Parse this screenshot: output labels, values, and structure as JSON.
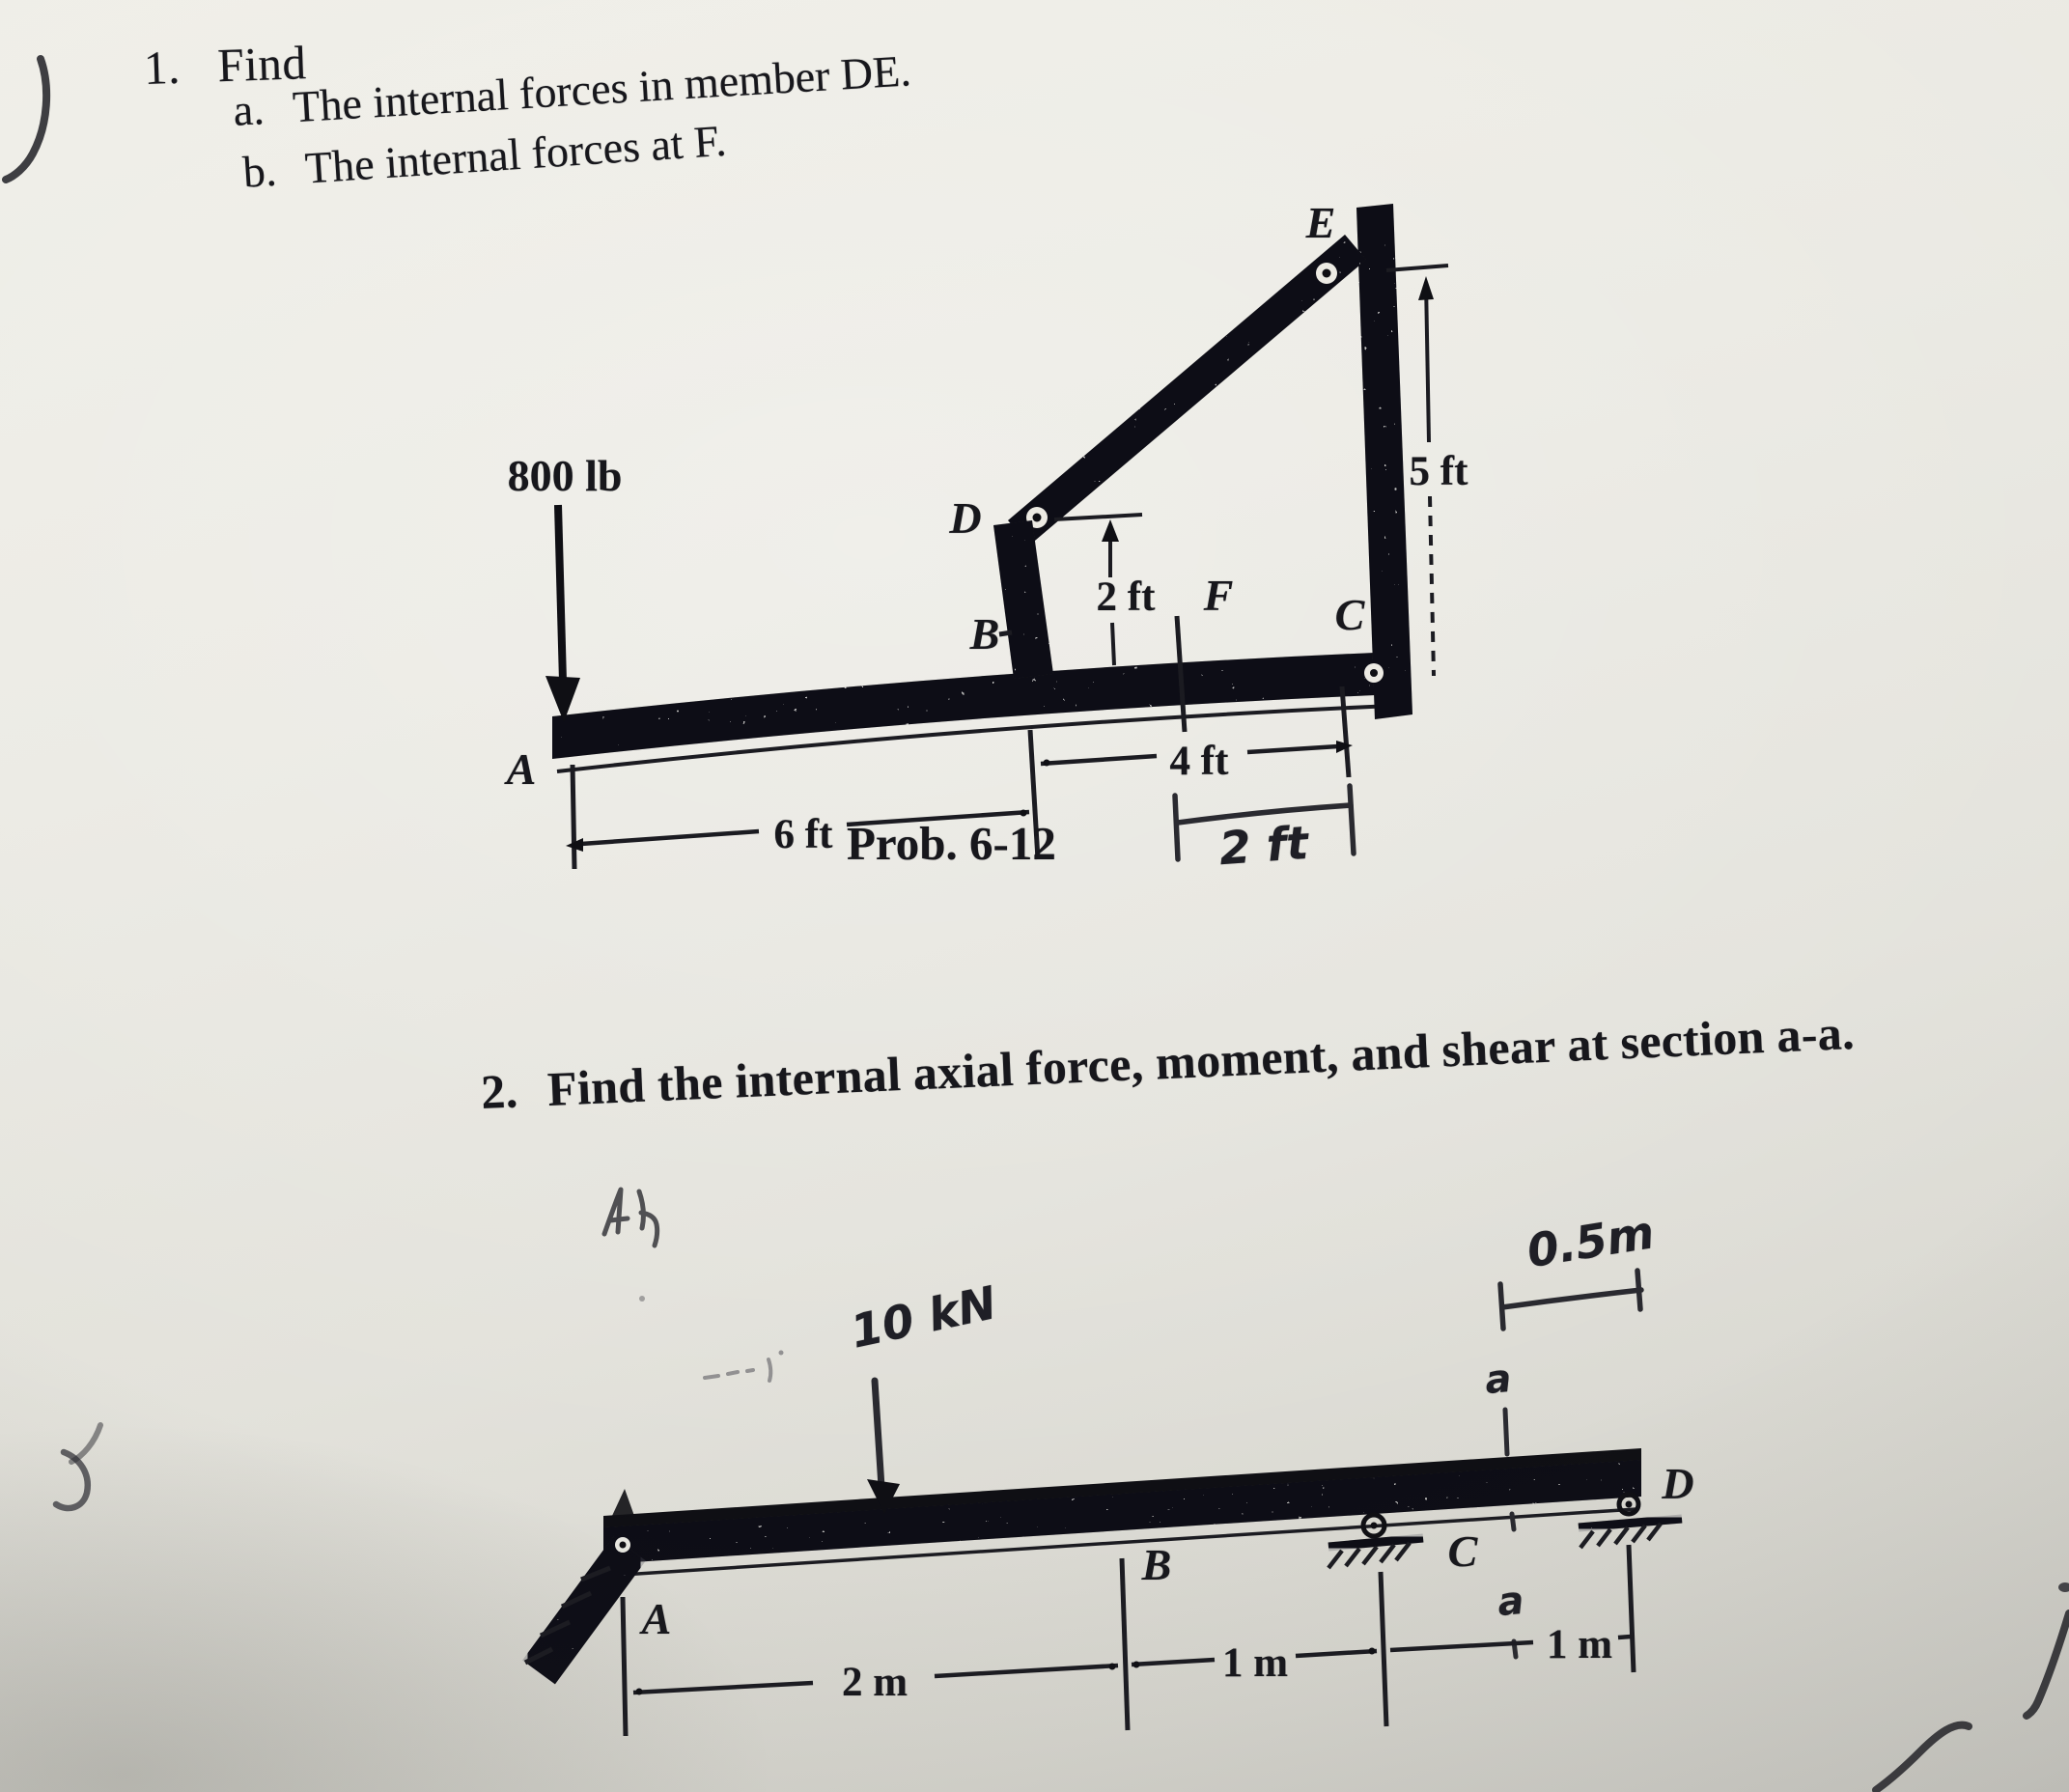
{
  "problem1": {
    "number": "1.",
    "title": "Find",
    "items": [
      {
        "label": "a.",
        "text": "The internal forces in member DE."
      },
      {
        "label": "b.",
        "text": "The internal forces at F."
      }
    ]
  },
  "diagram1": {
    "caption": "Prob. 6-12",
    "force": "800 lb",
    "nodes": {
      "A": "A",
      "B": "B",
      "C": "C",
      "D": "D",
      "E": "E",
      "F": "F"
    },
    "dims": {
      "six_ft": "6 ft",
      "four_ft": "4 ft",
      "two_ft_vertical": "2 ft",
      "five_ft": "5 ft",
      "two_ft_handwritten": "2 ft"
    }
  },
  "problem2": {
    "number": "2.",
    "text": "Find the internal axial force, moment, and shear at section a-a."
  },
  "diagram2": {
    "force": "10 kN",
    "nodes": {
      "A": "A",
      "B": "B",
      "C": "C",
      "D": "D"
    },
    "dims": {
      "two_m": "2 m",
      "one_m_bc": "1 m",
      "one_m_cd": "1 m",
      "half_m": "0.5m"
    },
    "section": {
      "top": "a",
      "bottom": "a"
    }
  }
}
